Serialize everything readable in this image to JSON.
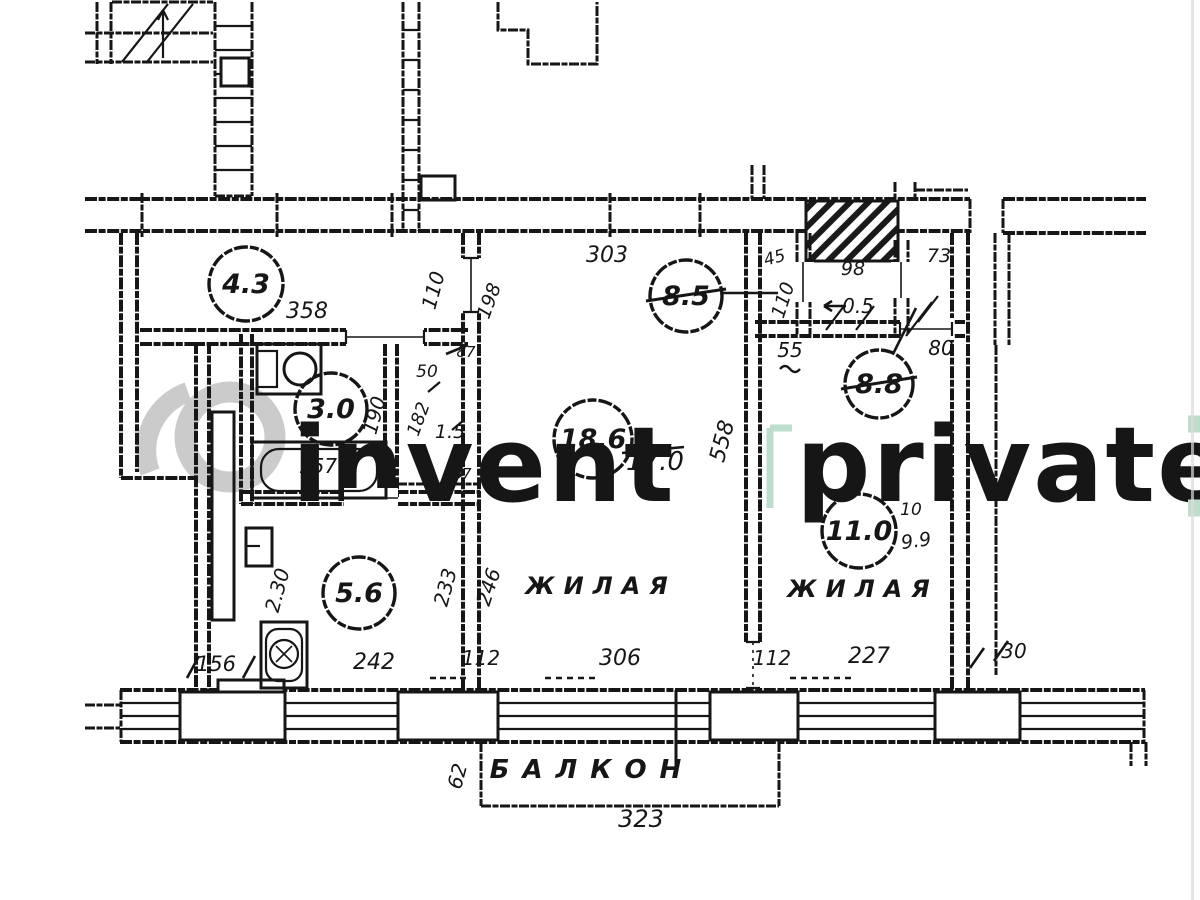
{
  "watermark": {
    "brand": "invent",
    "badge": "private",
    "ring_color": "#cbcbcb",
    "text_gray": "#c9c9c9",
    "text_green": "#bedecd"
  },
  "plan": {
    "ink": "#161616",
    "room_labels": [
      {
        "text": "ЖИЛАЯ",
        "x": 601,
        "y": 594,
        "ls": 9,
        "size": 24
      },
      {
        "text": "ЖИЛАЯ",
        "x": 863,
        "y": 597,
        "ls": 9,
        "size": 24
      },
      {
        "text": "БАЛКОН",
        "x": 592,
        "y": 778,
        "ls": 13,
        "size": 26
      }
    ],
    "area_circles": [
      {
        "value": "4.3",
        "x": 246,
        "y": 284,
        "r": 37
      },
      {
        "value": "3.0",
        "x": 331,
        "y": 409,
        "r": 36
      },
      {
        "value": "5.6",
        "x": 359,
        "y": 593,
        "r": 36
      },
      {
        "value": "18.6",
        "x": 593,
        "y": 439,
        "r": 39
      },
      {
        "value": "8.5",
        "x": 686,
        "y": 296,
        "r": 36,
        "struck": true
      },
      {
        "value": "8.8",
        "x": 879,
        "y": 384,
        "r": 34,
        "struck": true
      },
      {
        "value": "11.0",
        "x": 859,
        "y": 531,
        "r": 37
      }
    ],
    "dim_labels": [
      {
        "text": "358",
        "x": 307,
        "y": 318,
        "size": 22
      },
      {
        "text": "110",
        "x": 440,
        "y": 292,
        "rot": -75,
        "size": 20
      },
      {
        "text": "198",
        "x": 495,
        "y": 303,
        "rot": -70,
        "size": 19
      },
      {
        "text": "303",
        "x": 607,
        "y": 262,
        "size": 22
      },
      {
        "text": "45",
        "x": 776,
        "y": 263,
        "rot": -15,
        "size": 17
      },
      {
        "text": "110",
        "x": 789,
        "y": 302,
        "rot": -72,
        "size": 19
      },
      {
        "text": "98",
        "x": 853,
        "y": 275,
        "size": 19
      },
      {
        "text": "0.5",
        "x": 858,
        "y": 313,
        "size": 20
      },
      {
        "text": "73",
        "x": 939,
        "y": 262,
        "size": 19
      },
      {
        "text": "55",
        "x": 790,
        "y": 357,
        "size": 20
      },
      {
        "text": "80",
        "x": 941,
        "y": 355,
        "size": 20
      },
      {
        "text": "558",
        "x": 729,
        "y": 443,
        "rot": -75,
        "size": 22
      },
      {
        "text": "17.0",
        "x": 655,
        "y": 470,
        "size": 26
      },
      {
        "text": "190",
        "x": 381,
        "y": 417,
        "rot": -75,
        "size": 20
      },
      {
        "text": "157",
        "x": 318,
        "y": 473,
        "size": 20
      },
      {
        "text": "50",
        "x": 427,
        "y": 377,
        "size": 17
      },
      {
        "text": "182",
        "x": 424,
        "y": 421,
        "rot": -70,
        "size": 18
      },
      {
        "text": "1.5",
        "x": 450,
        "y": 438,
        "size": 19
      },
      {
        "text": "87",
        "x": 466,
        "y": 357,
        "size": 15
      },
      {
        "text": "87",
        "x": 462,
        "y": 479,
        "size": 15
      },
      {
        "text": "2.30",
        "x": 284,
        "y": 592,
        "rot": -75,
        "size": 20
      },
      {
        "text": "233",
        "x": 452,
        "y": 589,
        "rot": -75,
        "size": 20
      },
      {
        "text": "246",
        "x": 495,
        "y": 589,
        "rot": -72,
        "size": 20
      },
      {
        "text": "156",
        "x": 216,
        "y": 671,
        "size": 21
      },
      {
        "text": "242",
        "x": 374,
        "y": 669,
        "size": 22
      },
      {
        "text": "112",
        "x": 481,
        "y": 665,
        "size": 20
      },
      {
        "text": "306",
        "x": 620,
        "y": 665,
        "size": 22
      },
      {
        "text": "112",
        "x": 772,
        "y": 665,
        "size": 20
      },
      {
        "text": "227",
        "x": 869,
        "y": 663,
        "size": 22
      },
      {
        "text": "30",
        "x": 1014,
        "y": 658,
        "size": 20
      },
      {
        "text": "62",
        "x": 464,
        "y": 778,
        "rot": -75,
        "size": 20
      },
      {
        "text": "323",
        "x": 641,
        "y": 827,
        "size": 24
      },
      {
        "text": "10",
        "x": 911,
        "y": 515,
        "size": 17
      },
      {
        "text": "9.9",
        "x": 917,
        "y": 547,
        "rot": -8,
        "size": 19
      }
    ]
  }
}
